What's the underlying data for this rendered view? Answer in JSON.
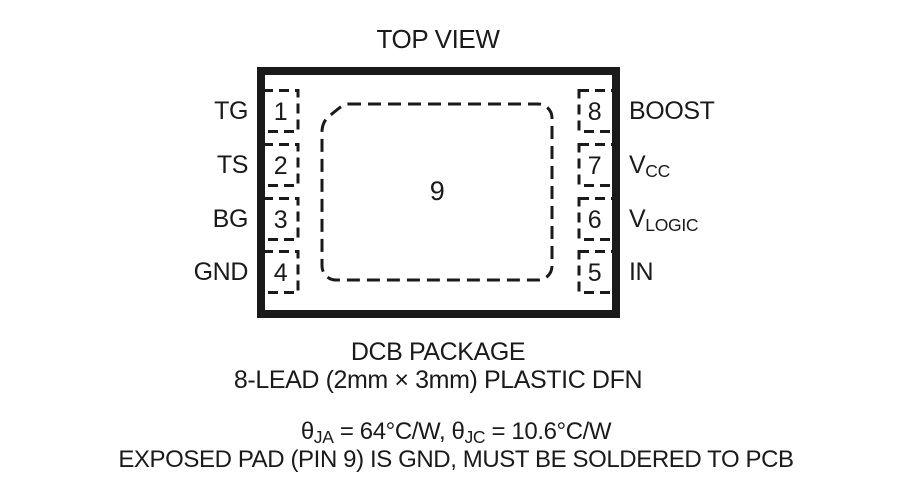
{
  "title": "TOP VIEW",
  "package": {
    "center_pad": {
      "number": "9"
    },
    "pins_left": [
      {
        "number": "1",
        "name": "TG"
      },
      {
        "number": "2",
        "name": "TS"
      },
      {
        "number": "3",
        "name": "BG"
      },
      {
        "number": "4",
        "name": "GND"
      }
    ],
    "pins_right": [
      {
        "number": "8",
        "base": "BOOST",
        "sub": ""
      },
      {
        "number": "7",
        "base": "V",
        "sub": "CC"
      },
      {
        "number": "6",
        "base": "V",
        "sub": "LOGIC"
      },
      {
        "number": "5",
        "base": "IN",
        "sub": ""
      }
    ]
  },
  "caption": {
    "line1": "DCB PACKAGE",
    "line2": "8-LEAD (2mm × 3mm) PLASTIC DFN"
  },
  "thermal": {
    "theta1": "θ",
    "sub1": "JA",
    "mid": " = 64°C/W, ",
    "theta2": "θ",
    "sub2": "JC",
    "tail": " = 10.6°C/W"
  },
  "note": "EXPOSED PAD (PIN 9) IS GND, MUST BE SOLDERED TO PCB",
  "colors": {
    "ink": "#1a1a1a",
    "background": "#ffffff"
  }
}
